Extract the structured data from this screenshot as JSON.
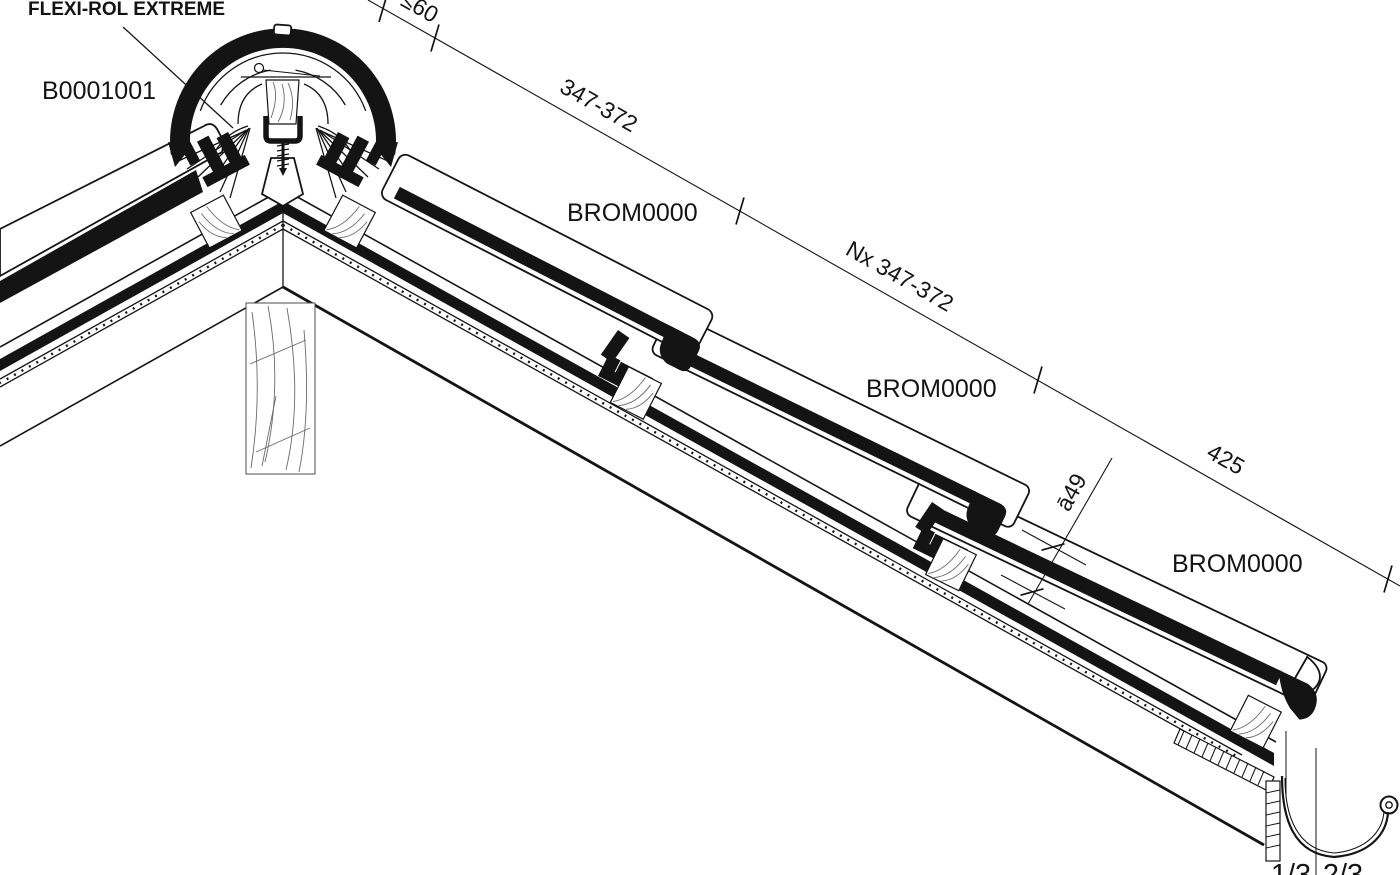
{
  "drawing": {
    "labels": {
      "flexi_rol": "FLEXI-ROL EXTREME",
      "ridge_code": "B0001001"
    },
    "tiles": [
      {
        "label": "BROM0000"
      },
      {
        "label": "BROM0000"
      },
      {
        "label": "BROM0000"
      }
    ],
    "dimensions": {
      "ridge_overlap": "≤60",
      "first_course": "347-372",
      "repeat_courses": "Nx 347-372",
      "eave_tile": "425",
      "headlap": "ā49",
      "gutter_left_third": "1/3",
      "gutter_right_two_thirds": "2/3"
    },
    "colors": {
      "ink": "#141414",
      "background": "#ffffff"
    }
  }
}
